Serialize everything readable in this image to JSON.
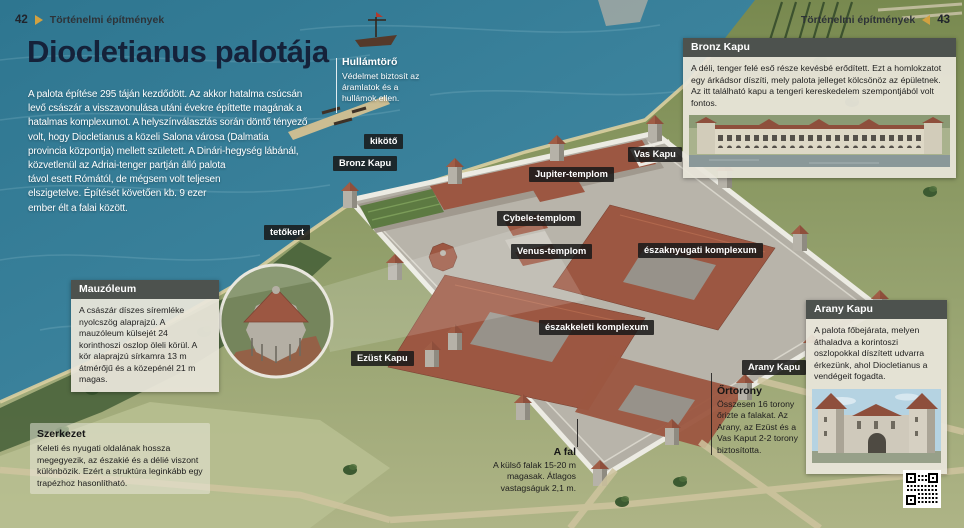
{
  "page": {
    "section": "Történelmi építmények",
    "page_left": "42",
    "page_right": "43",
    "title": "Diocletianus palotája",
    "intro": "A palota építése 295 táján kezdődött. Az akkor hatalma csúcsán levő császár a visszavonulása utáni évekre építtette magának a hatalmas komplexumot. A helyszínválasztás során döntő tényező volt, hogy Diocletianus a közeli Salona városa (Dalmatia provincia központja) mellett született. A Dinári-hegység lábánál, közvetlenül az Adriai-tenger partján álló palota távol esett Rómától, de mégsem volt teljesen elszigetelve. Építését követően kb. 9 ezer ember élt a falai között."
  },
  "map_labels": {
    "kikoto": "kikötő",
    "bronz_kapu": "Bronz Kapu",
    "vas_kapu": "Vas Kapu",
    "jupiter": "Jupiter-templom",
    "cybele": "Cybele-templom",
    "venus": "Venus-templom",
    "eszaknyugati": "északnyugati komplexum",
    "eszakkeleti": "északkeleti komplexum",
    "tetokert": "tetőkert",
    "ezust_kapu": "Ezüst Kapu",
    "arany_kapu": "Arany Kapu"
  },
  "annotations": {
    "hullamtoro": {
      "title": "Hullámtörő",
      "body": "Védelmet biztosít az áramlatok és a hullámok ellen."
    },
    "szerkezet": {
      "title": "Szerkezet",
      "body": "Keleti és nyugati oldalának hossza megegyezik, az északié és a délié viszont különbözik. Ezért a struktúra leginkább egy trapézhoz hasonlítható."
    },
    "a_fal": {
      "title": "A fal",
      "body": "A külső falak 15-20 m magasak. Átlagos vastagságuk 2,1 m."
    },
    "ortorony": {
      "title": "Őrtorony",
      "body": "Összesen 16 torony őrizte a falakat. Az Arany, az Ezüst és a Vas Kaput 2-2 torony biztosította."
    }
  },
  "info_boxes": {
    "mauzoleum": {
      "title": "Mauzóleum",
      "body": "A császár díszes síremléke nyolcszög alaprajzú. A mauzóleum külsejét 24 korinthoszi oszlop öleli körül. A kör alaprajzú sírkamra 13 m átmérőjű és a közepénél 21 m magas."
    },
    "bronz_kapu": {
      "title": "Bronz Kapu",
      "body": "A déli, tenger felé eső része kevésbé erődített. Ezt a homlokzatot egy árkádsor díszíti, mely palota jelleget kölcsönöz az épületnek. Az itt található kapu a tengeri kereskedelem szempontjából volt fontos."
    },
    "arany_kapu": {
      "title": "Arany Kapu",
      "body": "A palota főbejárata, melyen áthaladva a korintoszi oszlopokkal díszített udvarra érkezünk, ahol Diocletianus a vendégeit fogadta."
    },
    "palota_adatai": {
      "title": "A palota adatai",
      "rows": [
        {
          "label": "Építésének ideje:",
          "value": " 295–305"
        },
        {
          "label": "Építtető:",
          "value": " Diocletianus császár"
        },
        {
          "label": "Elhelyezkedése:",
          "value": " a mai Splitben, Horvátországban"
        },
        {
          "label": "Területe:",
          "value": " kb. 30 ezer m²"
        },
        {
          "label": "Felvételi év (Világörökség):",
          "value": " 1979"
        }
      ]
    }
  },
  "colors": {
    "ocean": "#3c7f95",
    "accent_gold": "#d2a140",
    "label_bg": "#1a1a1a",
    "box_bg": "#e9e5da",
    "box_header_bg": "#4d524e",
    "title_text": "#15223a",
    "roof": "#9c5742",
    "wall": "#bdb9b0"
  }
}
